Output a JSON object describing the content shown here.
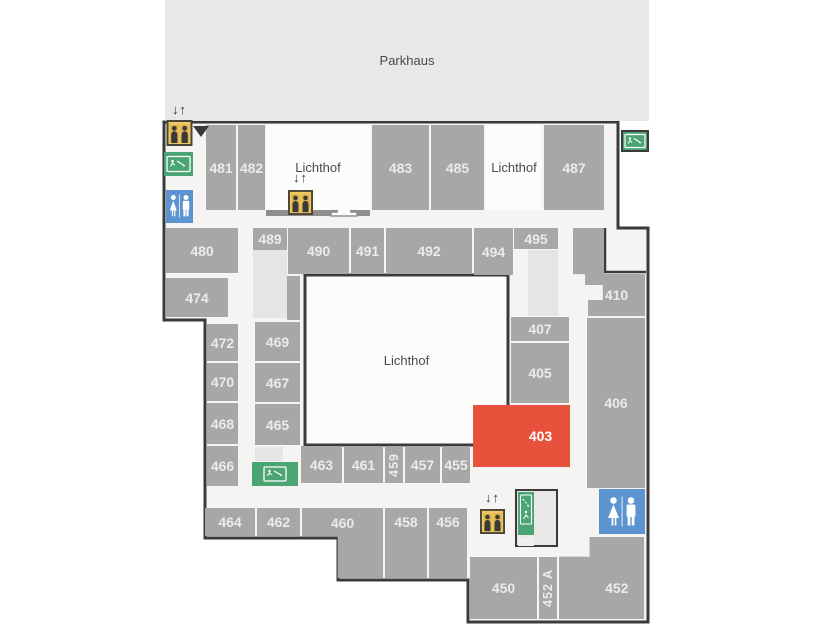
{
  "areas": {
    "parkhaus": {
      "label": "Parkhaus"
    },
    "lichthof_top_left": {
      "label": "Lichthof"
    },
    "lichthof_top_right": {
      "label": "Lichthof"
    },
    "lichthof_central": {
      "label": "Lichthof"
    }
  },
  "elevator": {
    "arrows": "↓↑"
  },
  "colors": {
    "wall": "#3a3a3a",
    "corridor": "#f5f4f2",
    "room": "#a8a7a5",
    "room_text": "#ebebe9",
    "highlight_room": "#e8513b",
    "parkhaus_bg": "#e8e8e8",
    "stairs_light": "#e6e5e3",
    "exit_green": "#4ba572",
    "wc_blue": "#5b94d0",
    "elevator_yellow": "#edc963"
  },
  "rooms": [
    {
      "number": "481"
    },
    {
      "number": "482"
    },
    {
      "number": "483"
    },
    {
      "number": "485"
    },
    {
      "number": "487"
    },
    {
      "number": "480"
    },
    {
      "number": "489"
    },
    {
      "number": "490"
    },
    {
      "number": "491"
    },
    {
      "number": "492"
    },
    {
      "number": "494"
    },
    {
      "number": "495"
    },
    {
      "number": "474"
    },
    {
      "number": "410"
    },
    {
      "number": "472"
    },
    {
      "number": "470"
    },
    {
      "number": "468"
    },
    {
      "number": "466"
    },
    {
      "number": "469"
    },
    {
      "number": "467"
    },
    {
      "number": "465"
    },
    {
      "number": "407"
    },
    {
      "number": "405"
    },
    {
      "number": "403"
    },
    {
      "number": "406"
    },
    {
      "number": "463"
    },
    {
      "number": "461"
    },
    {
      "number": "459"
    },
    {
      "number": "457"
    },
    {
      "number": "455"
    },
    {
      "number": "464"
    },
    {
      "number": "462"
    },
    {
      "number": "460"
    },
    {
      "number": "458"
    },
    {
      "number": "456"
    },
    {
      "number": "450"
    },
    {
      "number": "452 A"
    },
    {
      "number": "452"
    }
  ]
}
